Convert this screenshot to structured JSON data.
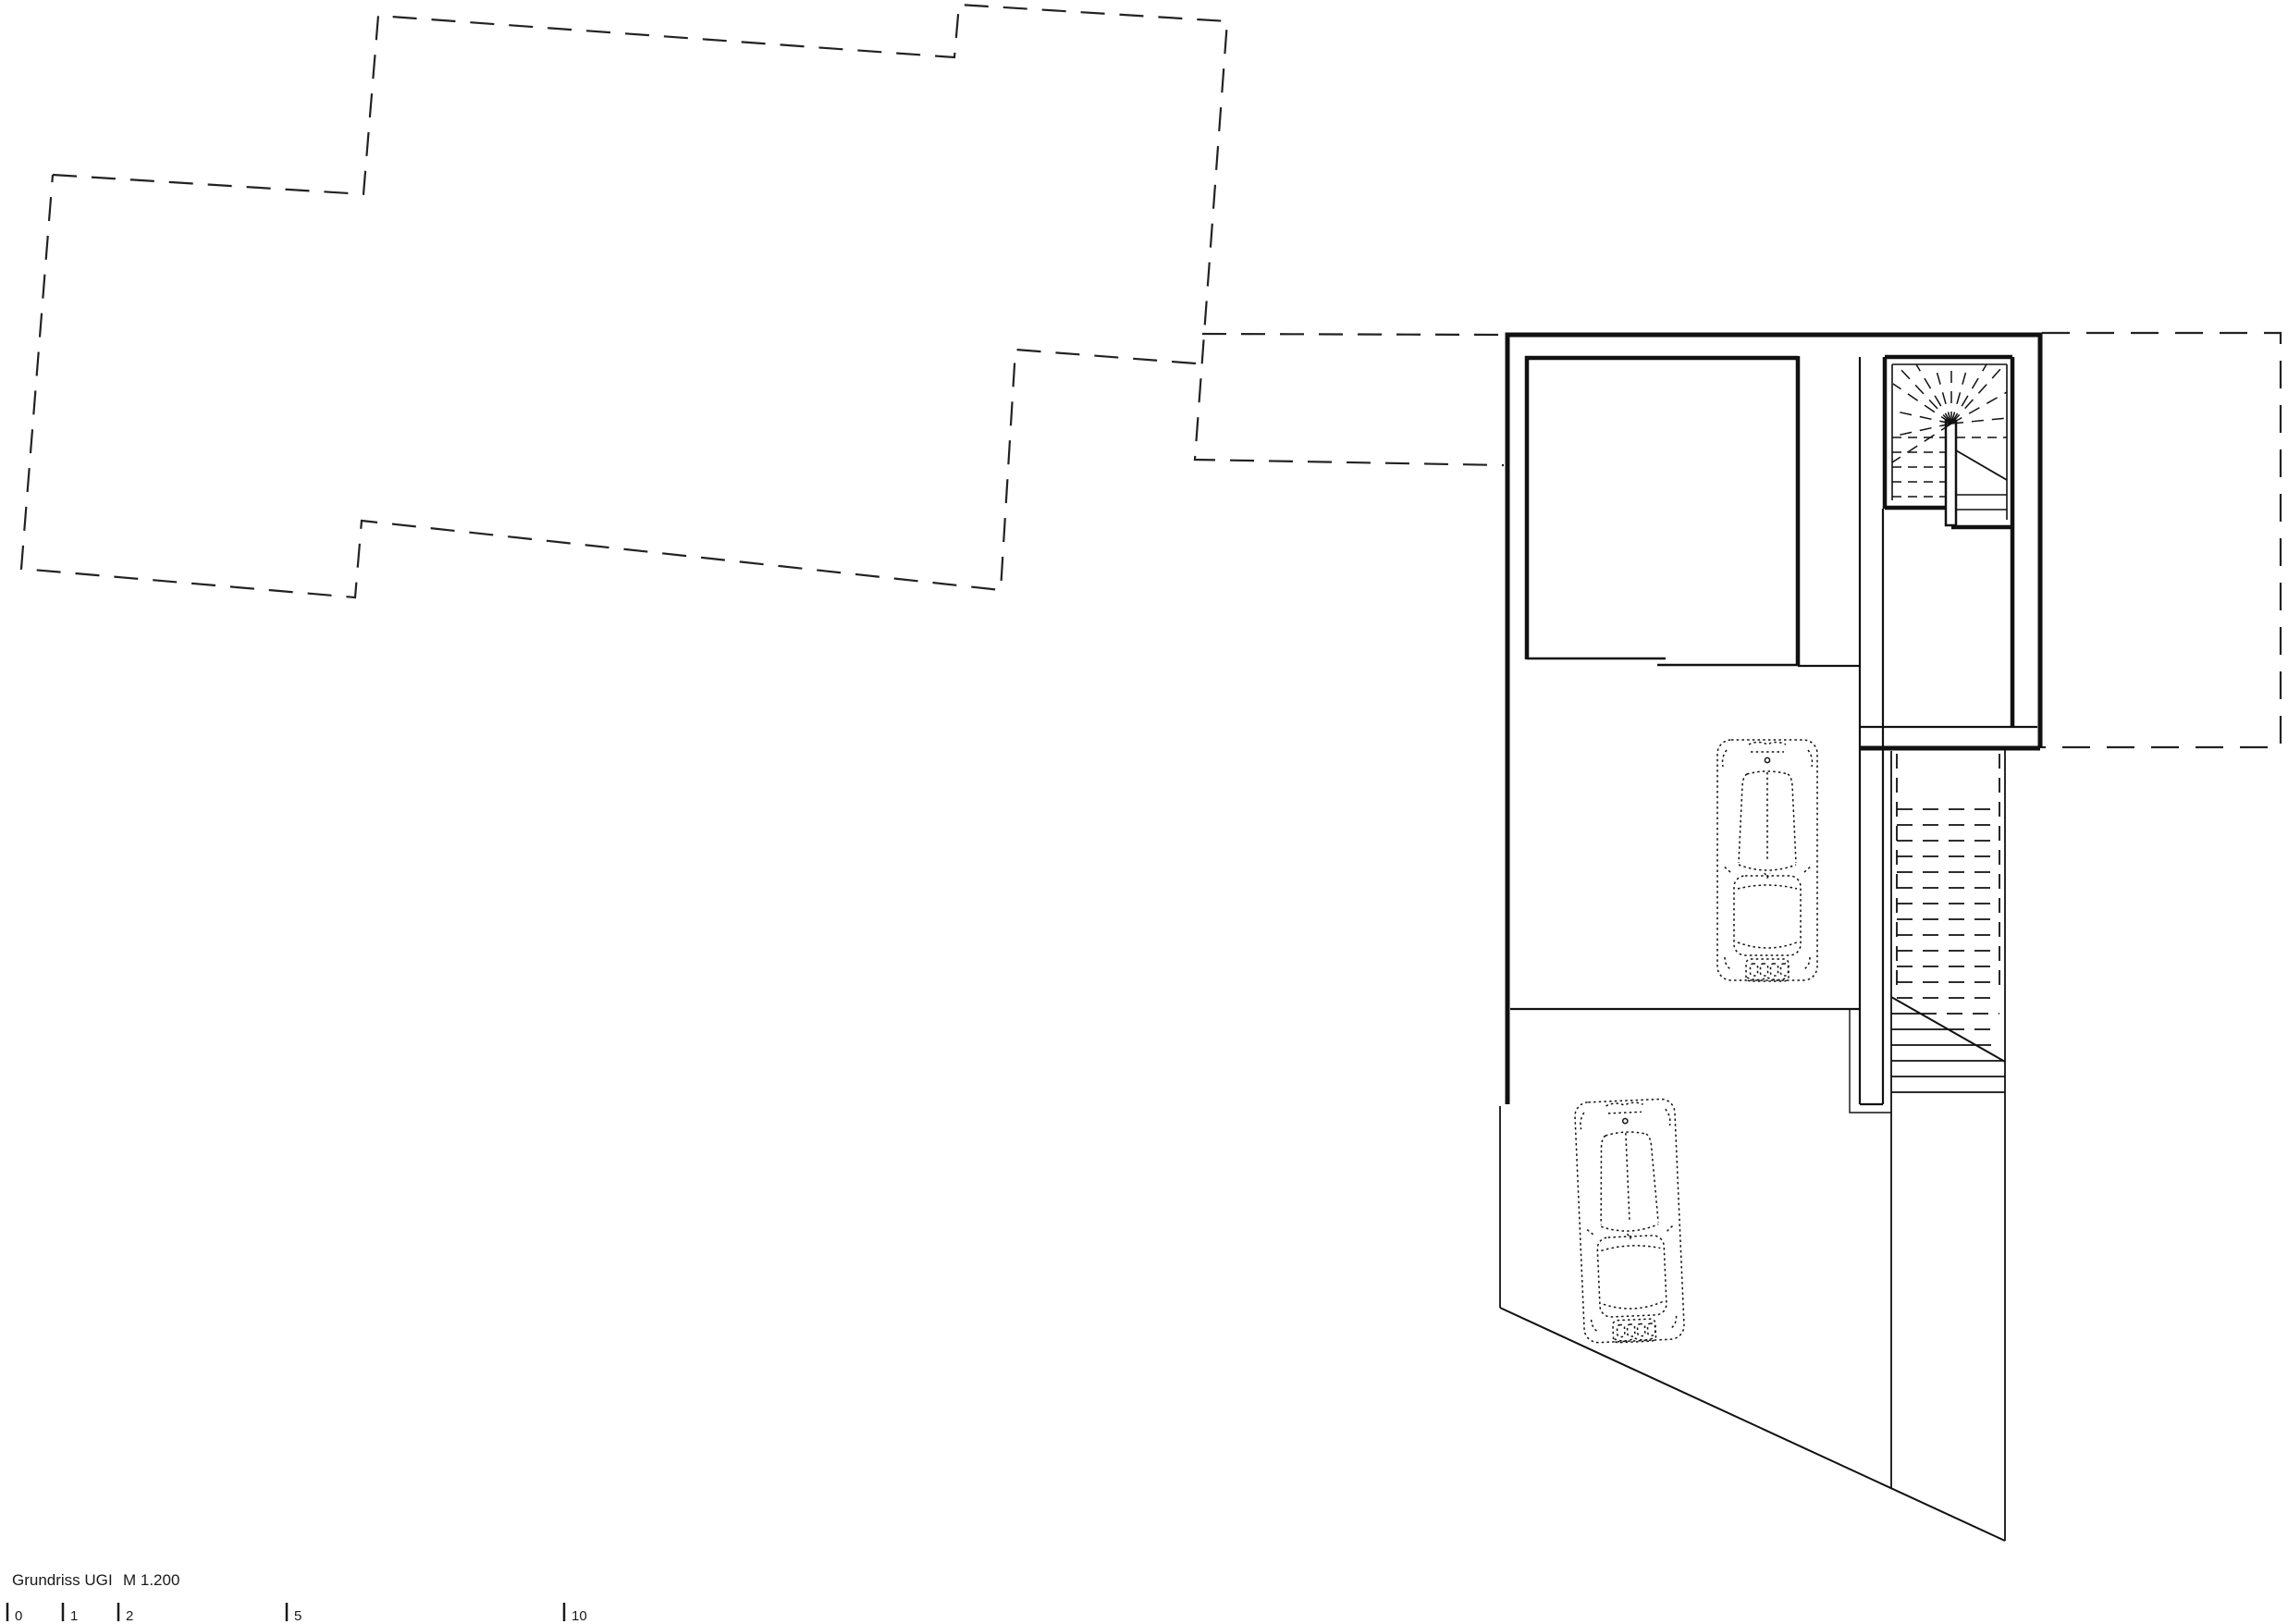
{
  "title_block": {
    "drawing_title": "Grundriss UG",
    "separator": "I",
    "scale_text": "M 1.200"
  },
  "scale_bar": {
    "ticks": [
      {
        "label": "0"
      },
      {
        "label": "1"
      },
      {
        "label": "2"
      },
      {
        "label": "5"
      },
      {
        "label": "10"
      }
    ]
  },
  "colors": {
    "line": "#1a1a1a",
    "background": "#ffffff"
  },
  "plan_features": [
    "upper-floor-dashed-projection",
    "terrace-dashed-projection",
    "basement-outer-walls",
    "cellar-room",
    "corridor",
    "winder-stair",
    "exterior-stair",
    "garage",
    "driveway",
    "car-top-view",
    "car-top-view"
  ]
}
